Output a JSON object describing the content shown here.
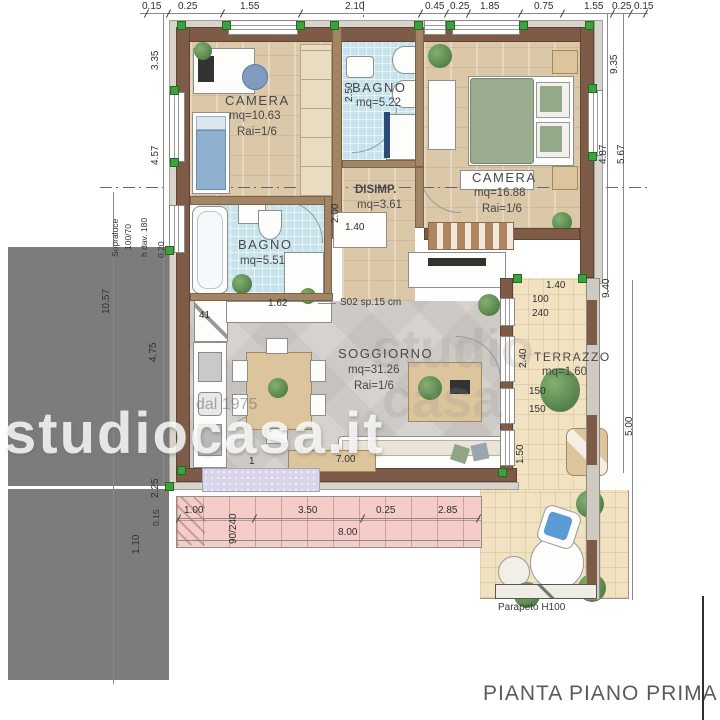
{
  "title": "PIANTA PIANO PRIMA 1/50",
  "rooms": {
    "camera1": {
      "name": "CAMERA",
      "area": "mq=10.63",
      "ratio": "Rai=1/6"
    },
    "bagno1": {
      "name": "BAGNO",
      "area": "mq=5.22"
    },
    "camera2": {
      "name": "CAMERA",
      "area": "mq=16.88",
      "ratio": "Rai=1/6"
    },
    "disimp": {
      "name": "DISIMP.",
      "area": "mq=3.61"
    },
    "bagno2": {
      "name": "BAGNO",
      "area": "mq=5.51"
    },
    "soggiorno": {
      "name": "SOGGIORNO",
      "area": "mq=31.26",
      "ratio": "Rai=1/6"
    },
    "terrazzo": {
      "name": "TERRAZZO",
      "area": "mq=1.60"
    }
  },
  "dims": {
    "top": [
      "0.15",
      "0.25",
      "1.55",
      "2.10",
      "0.45",
      "0.25",
      "1.85",
      "0.75",
      "1.55",
      "0.25",
      "0.15"
    ],
    "left": [
      "3.35",
      "4.57",
      "0.20",
      "10.57",
      "4.75",
      "2.25",
      "0.15",
      "1.10"
    ],
    "right": [
      "9.35",
      "4.87",
      "5.67",
      "9.40",
      "5.00"
    ],
    "bottom": [
      "1.00",
      "90/240",
      "3.50",
      "0.25",
      "2.85",
      "8.00"
    ],
    "inner": {
      "bagno1_width": "2.50",
      "disimp_height": "2.00",
      "cabinet": "1.40",
      "terr_top": "1.40",
      "win_w": "100",
      "win_h": "240",
      "terr_mid": "2.40",
      "win150a": "150",
      "win150b": "150",
      "terr_bot": "1.50",
      "kitchen": "1.62",
      "unit41": "41",
      "door1": "1",
      "console": "7.00"
    }
  },
  "annotations": {
    "slab": "S02 sp.15 cm",
    "sopraluce_line1": "Sopraluce",
    "sopraluce_line2": "100/70",
    "h_davanzale": "h dav. 180",
    "parapet": "Parapeto H100"
  },
  "watermark": {
    "brand": "studiocasa.it",
    "since": "dal 1975",
    "ghost1": "studio",
    "ghost2": "casa"
  },
  "colors": {
    "wall_brown": "#7d5b46",
    "bath_tile": "#c7e3eb",
    "wood_floor": "#dbc8a8",
    "living_floor": "#d6d2cd",
    "terrace_beige": "#f1e3c2",
    "balcony_pink": "#f5cdc8",
    "neighbor_gray": "#7c7c7a",
    "corner_marker_green": "#3da23d",
    "cushion_blue": "#5b9bd5",
    "plant_green": "#5c8f52"
  }
}
